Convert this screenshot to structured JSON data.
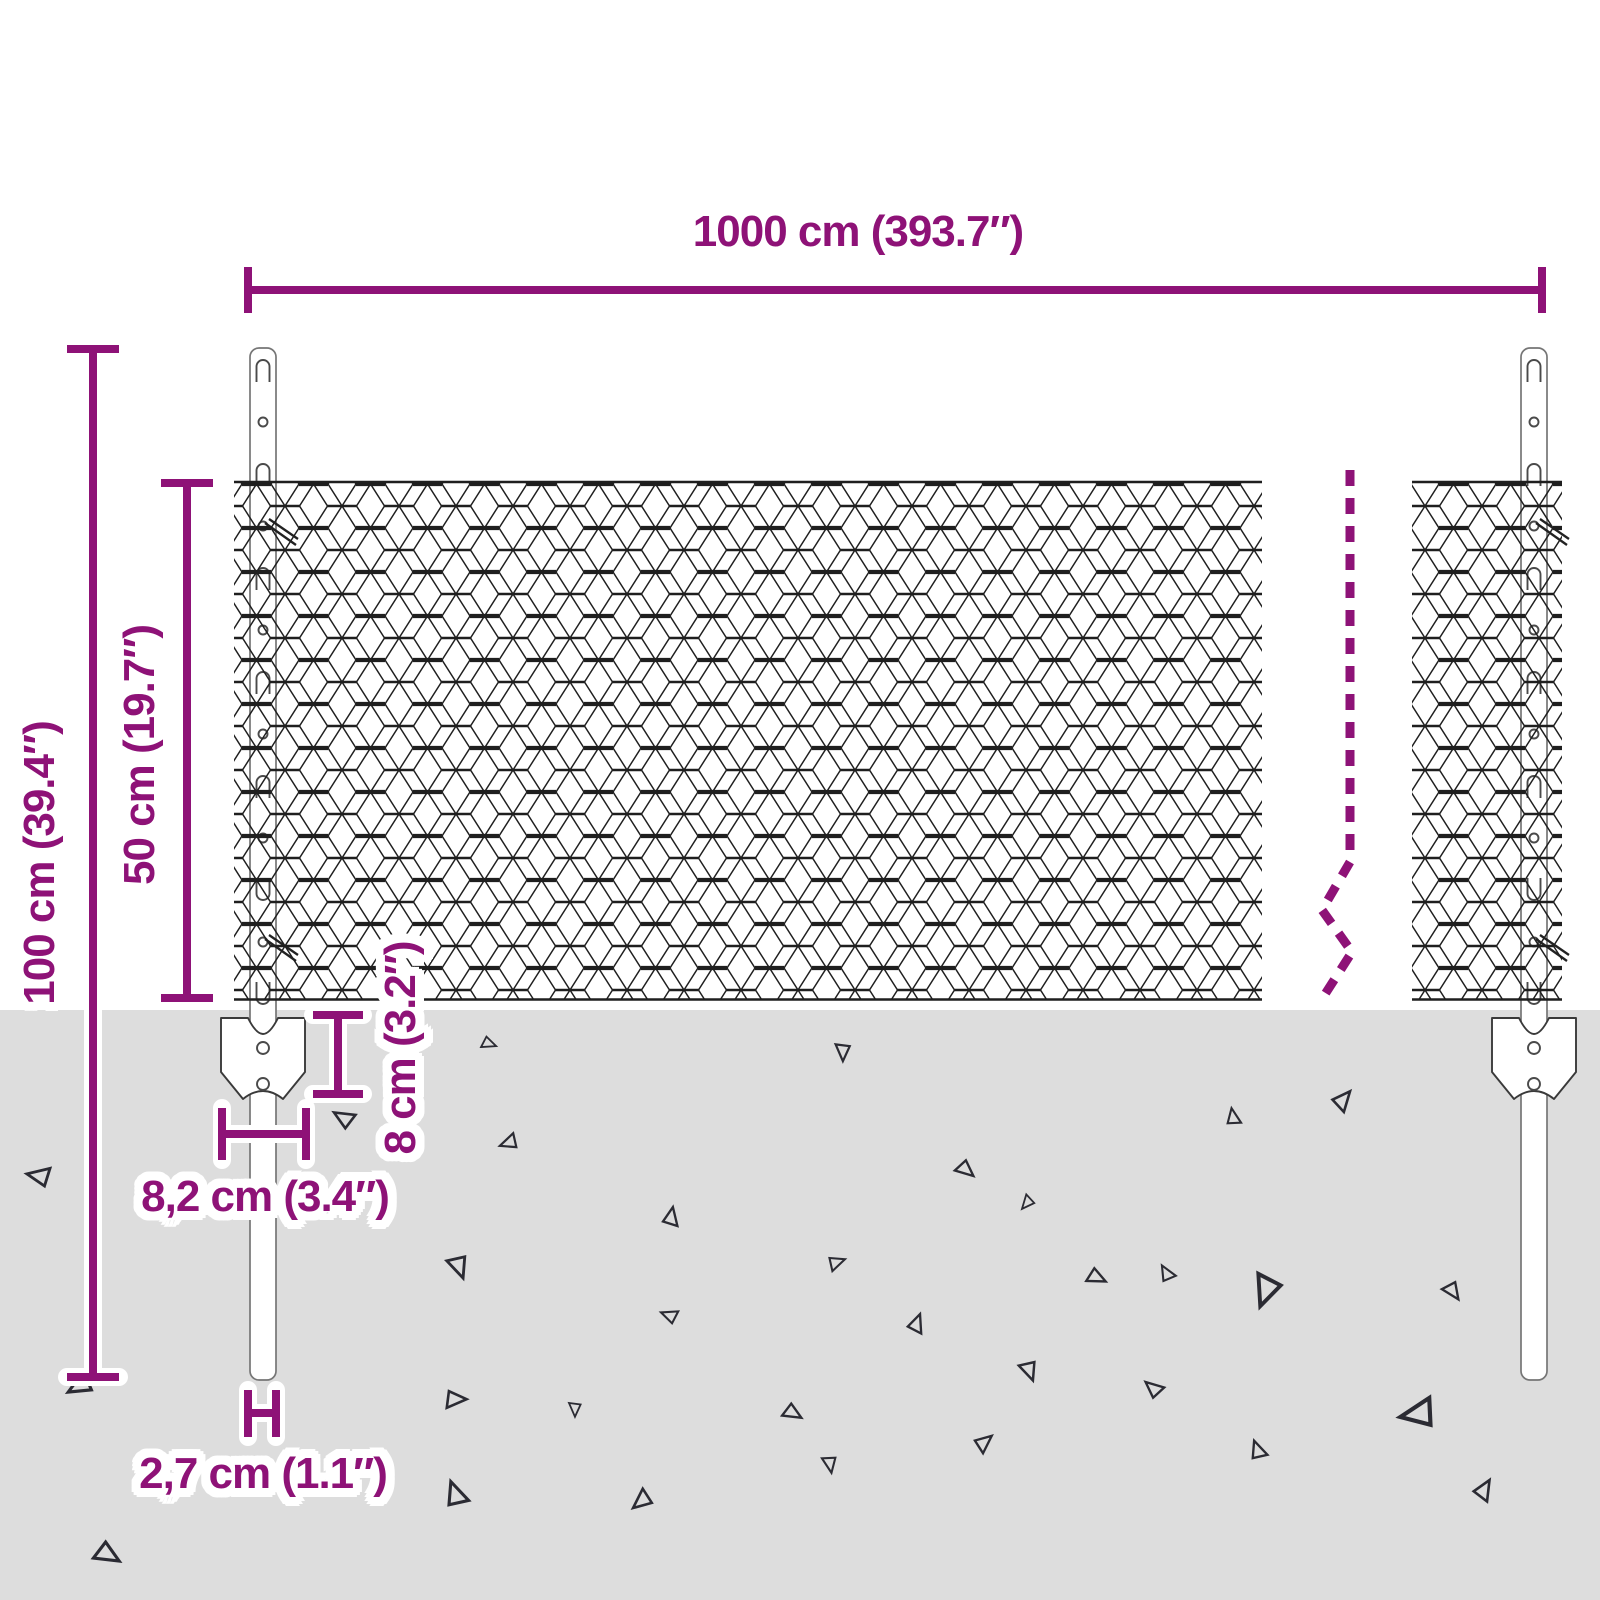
{
  "diagram": {
    "dimensions": {
      "length": "1000 cm (393.7″)",
      "total_height": "100 cm (39.4″)",
      "mesh_height": "50 cm (19.7″)",
      "anchor_depth": "8 cm (3.2″)",
      "anchor_width": "8,2 cm (3.4″)",
      "post_width": "2,7 cm (1.1″)"
    },
    "colors": {
      "dimension_accent": "#8e1277",
      "ground": "#dddddd",
      "mesh_line": "#1f1f1f",
      "triangle": "#2b2b33"
    }
  }
}
